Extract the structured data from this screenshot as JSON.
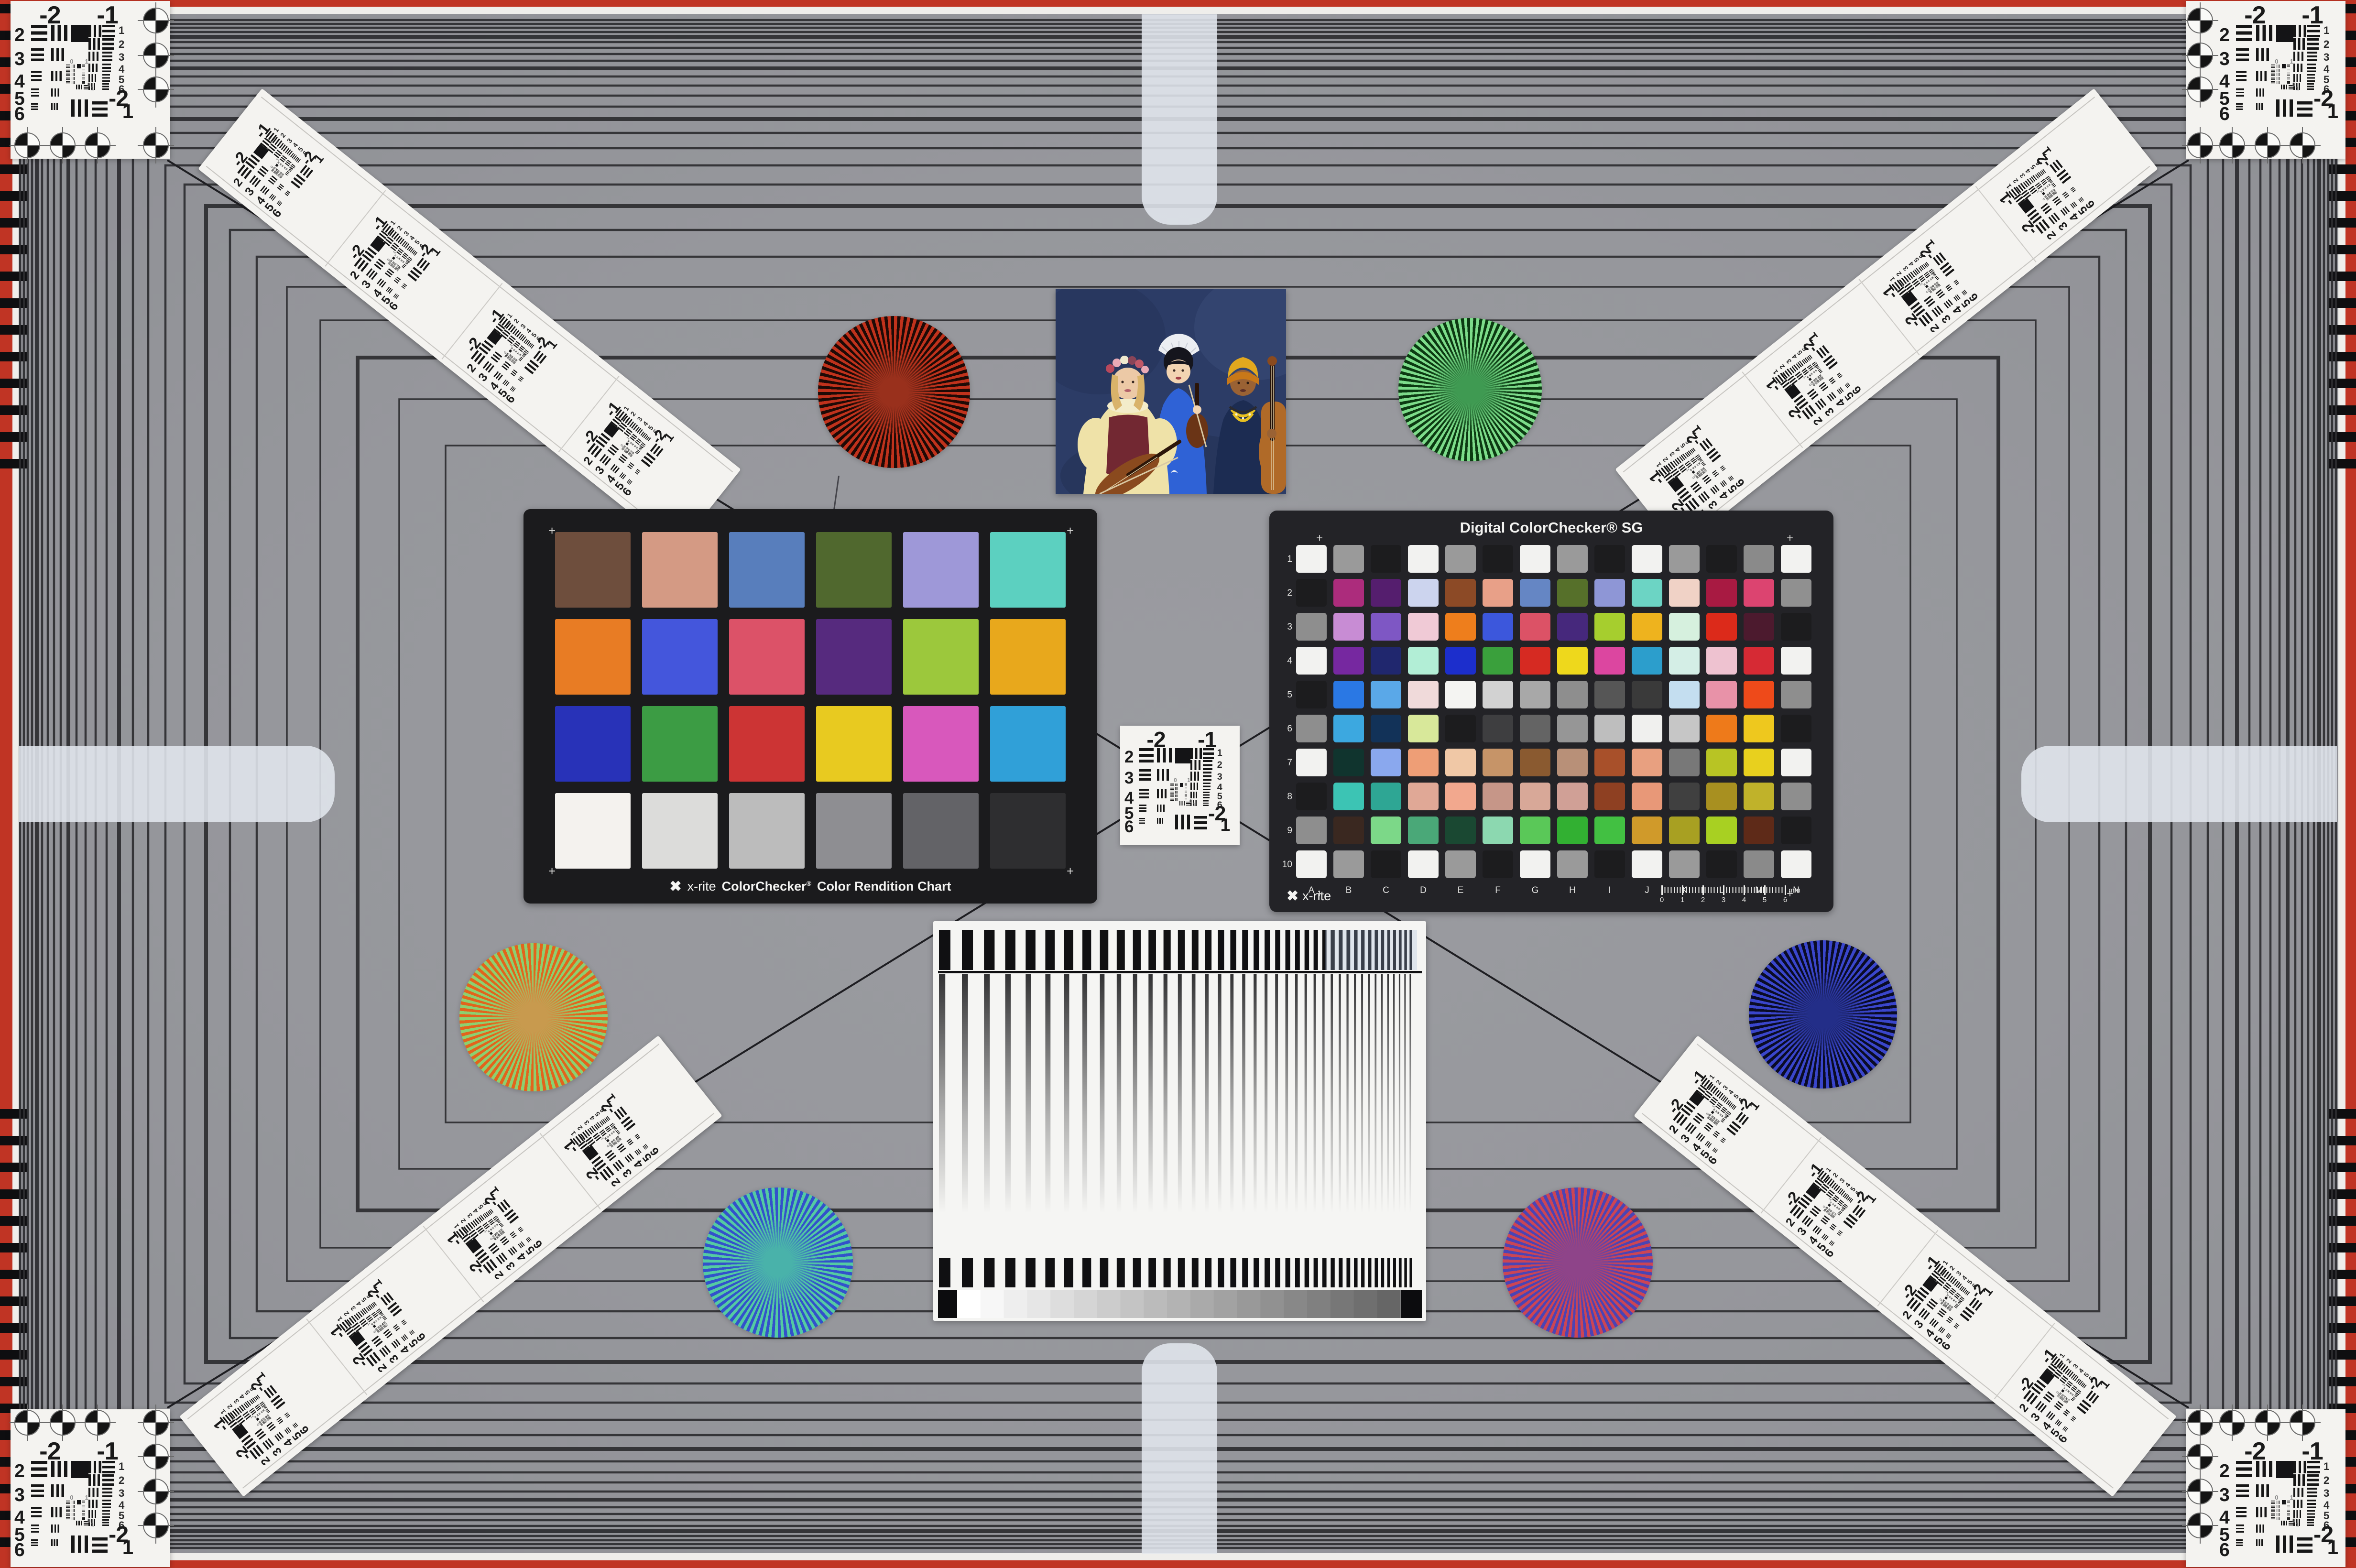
{
  "colors": {
    "background": "#96979c",
    "edge_red": "#c03424",
    "edge_white": "#efeeeb",
    "frame_line": "#2c2c30",
    "diagonal_line": "#1e1e22",
    "card_white": "#f4f3f0",
    "chart_frame": "#1b1b1d",
    "sg_frame": "#232327",
    "tab_white": "#e3e7ee",
    "ink": "#141416"
  },
  "usaf_target": {
    "top_labels": [
      "-2",
      "-1"
    ],
    "left_numbers": [
      "2",
      "3",
      "4",
      "5",
      "6"
    ],
    "right_numbers": [
      "1",
      "2",
      "3",
      "4",
      "5",
      "6"
    ],
    "bottom_labels": [
      "-2",
      "1"
    ],
    "mini_labels": [
      "0",
      "1",
      "0",
      "1"
    ]
  },
  "colorchecker": {
    "brand": "x-rite",
    "title": "ColorChecker",
    "registered": "®",
    "subtitle": "Color Rendition Chart",
    "patches": [
      [
        "#6e4e3d",
        "#d49a84",
        "#587ebc",
        "#50682e",
        "#9e98d8",
        "#5cd0c0"
      ],
      [
        "#e87c24",
        "#4456dc",
        "#dc5268",
        "#562a7e",
        "#9cc83c",
        "#e8a81c"
      ],
      [
        "#2832b8",
        "#3c9c44",
        "#cc3434",
        "#e8ca20",
        "#d858bc",
        "#30a0d8"
      ],
      [
        "#f4f2ee",
        "#dcdcda",
        "#bcbcbc",
        "#8e8e92",
        "#636367",
        "#2e2e30"
      ]
    ]
  },
  "colorchecker_sg": {
    "title": "Digital ColorChecker® SG",
    "brand": "x-rite",
    "row_labels": [
      "1",
      "2",
      "3",
      "4",
      "5",
      "6",
      "7",
      "8",
      "9",
      "10"
    ],
    "col_labels": [
      "A",
      "B",
      "C",
      "D",
      "E",
      "F",
      "G",
      "H",
      "I",
      "J",
      "K",
      "L",
      "M",
      "N"
    ],
    "ruler_numbers": [
      "0",
      "1",
      "2",
      "3",
      "4",
      "5",
      "6"
    ],
    "ruler_unit": "mm",
    "patches": [
      [
        "#f2f2f0",
        "#9a9a9a",
        "#1c1c1e",
        "#f2f2f0",
        "#9a9a9a",
        "#1c1c1e",
        "#f2f2f0",
        "#9a9a9a",
        "#1c1c1e",
        "#f2f2f0",
        "#9a9a9a",
        "#1c1c1e",
        "#8a8a8a",
        "#f2f2f0"
      ],
      [
        "#1c1c1e",
        "#ac2c7c",
        "#551e6e",
        "#ccd4ee",
        "#8c4a26",
        "#e8a088",
        "#6586c4",
        "#56702a",
        "#8e96d6",
        "#6cd4c4",
        "#f0d2c6",
        "#a81a42",
        "#dc4470",
        "#909090"
      ],
      [
        "#8e8e8e",
        "#c88cd4",
        "#7e57c4",
        "#f0cad6",
        "#ee7e1c",
        "#3c57dc",
        "#dc5266",
        "#46287c",
        "#a6ce2e",
        "#eeb31e",
        "#d6f0de",
        "#dc2a1a",
        "#4c1a2e",
        "#1c1c1e"
      ],
      [
        "#f2f2f0",
        "#7628a0",
        "#20276e",
        "#b2eed6",
        "#1c2ecc",
        "#3aa03c",
        "#d62a22",
        "#eed81c",
        "#dc46a0",
        "#2c9ecc",
        "#d4eee6",
        "#eec2d0",
        "#d62a34",
        "#f2f2f0"
      ],
      [
        "#1c1c1e",
        "#2a78e4",
        "#5aa8e8",
        "#f0dada",
        "#f4f4f2",
        "#d2d2d2",
        "#a8a8a8",
        "#8e8e8e",
        "#565656",
        "#3a3a3a",
        "#c4def0",
        "#e892a8",
        "#ee4a1a",
        "#8e8e8e"
      ],
      [
        "#8e8e8e",
        "#3ca8e0",
        "#123258",
        "#d8e89a",
        "#1c1c1e",
        "#3e3e40",
        "#646464",
        "#969696",
        "#bebebe",
        "#f0f0ee",
        "#c6c6c6",
        "#ee7a1a",
        "#eec81e",
        "#1c1c1e"
      ],
      [
        "#f2f2f0",
        "#10342e",
        "#8aa8ee",
        "#ee9e76",
        "#f0c8a6",
        "#c69468",
        "#8a5a30",
        "#b89078",
        "#a8502a",
        "#e8a080",
        "#787878",
        "#b8c424",
        "#e8d01e",
        "#f2f2f0"
      ],
      [
        "#1c1c1e",
        "#3cc4b4",
        "#2ea694",
        "#e0a896",
        "#f2a88e",
        "#c69688",
        "#d8a898",
        "#d0a096",
        "#8e4022",
        "#e89878",
        "#404040",
        "#a89020",
        "#c0b22a",
        "#8e8e8e"
      ],
      [
        "#8e8e8e",
        "#3a2820",
        "#7cd888",
        "#4aa878",
        "#1a4832",
        "#8cd8b0",
        "#5ac858",
        "#32b032",
        "#42c042",
        "#d09a2a",
        "#a8a022",
        "#a8d022",
        "#5e2a18",
        "#1c1c1e"
      ],
      [
        "#f2f2f0",
        "#9a9a9a",
        "#1c1c1e",
        "#f2f2f0",
        "#9a9a9a",
        "#1c1c1e",
        "#f2f2f0",
        "#9a9a9a",
        "#1c1c1e",
        "#f2f2f0",
        "#9a9a9a",
        "#1c1c1e",
        "#8a8a8a",
        "#f2f2f0"
      ]
    ]
  },
  "siemens_stars": [
    {
      "name": "star-red",
      "ray_color": "#c0321c",
      "gap_color": "#1e0a06",
      "core_color": "#99301c"
    },
    {
      "name": "star-green",
      "ray_color": "#7ddc8a",
      "gap_color": "#0c3a12",
      "core_color": "#3f9a52"
    },
    {
      "name": "star-amber",
      "ray_color": "#e2641c",
      "gap_color": "#8cd070",
      "core_color": "#c89a4e"
    },
    {
      "name": "star-navy",
      "ray_color": "#3a46cc",
      "gap_color": "#0a0c26",
      "core_color": "#232e88"
    },
    {
      "name": "star-teal",
      "ray_color": "#54cba2",
      "gap_color": "#3351cb",
      "core_color": "#49b2aa"
    },
    {
      "name": "star-magenta",
      "ray_color": "#cc4554",
      "gap_color": "#4b44b4",
      "core_color": "#8e4489"
    }
  ],
  "photo": {
    "background": "#2c3c66",
    "skin_fair": "#ecc9a6",
    "skin_light": "#f2d4b2",
    "skin_deep": "#9a6234",
    "hair_blonde": "#d9b36a",
    "hair_black": "#15151d",
    "dress": "#efe2a8",
    "bodice": "#722832",
    "fan": "#eceef2",
    "robe_blue": "#2f62d6",
    "robe_navy": "#1c2c52",
    "wrap_yellow": "#e2a81e",
    "wrap_orange": "#c87818",
    "beads": "#e8c020",
    "cello": "#b06a28",
    "violin": "#8a4a1e"
  }
}
